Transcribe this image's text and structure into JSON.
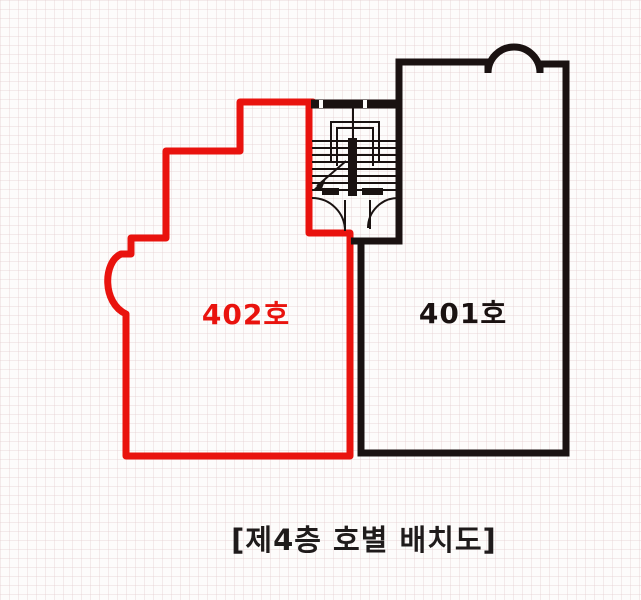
{
  "diagram": {
    "kind": "floor-plan",
    "caption": "[제4층 호별 배치도]"
  },
  "units": {
    "u402": {
      "label": "402호"
    },
    "u401": {
      "label": "401호"
    }
  },
  "stair": {
    "name": "staircase"
  },
  "colors": {
    "red": "#e9130e",
    "black": "#1a1211",
    "caption": "#1f1b1b",
    "white": "#fdfcfb"
  }
}
